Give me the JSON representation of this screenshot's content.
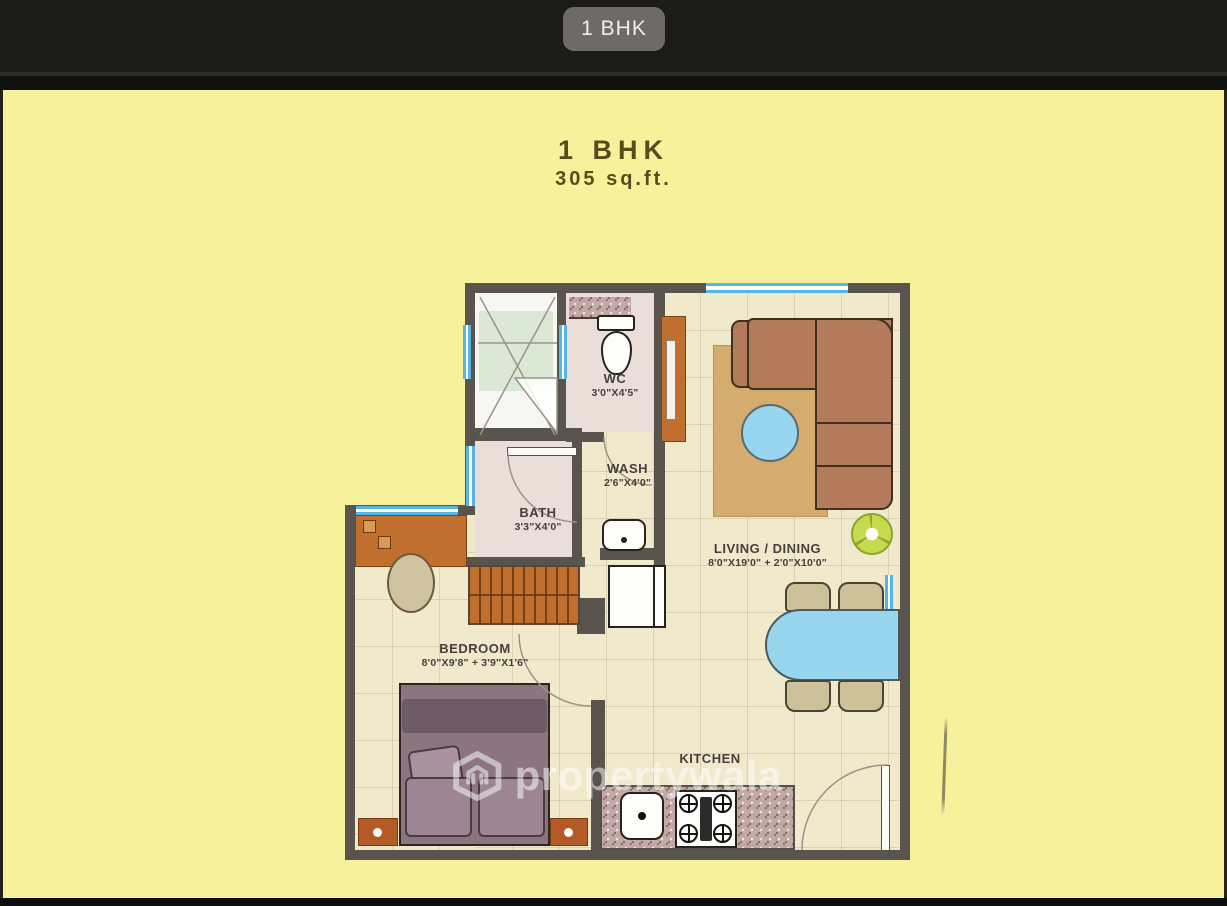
{
  "header": {
    "tab_label": "1 BHK"
  },
  "plan_title": {
    "title": "1 BHK",
    "area": "305 sq.ft."
  },
  "rooms": {
    "wc": {
      "name": "WC",
      "dims": "3'0\"X4'5\""
    },
    "wash": {
      "name": "WASH",
      "dims": "2'6\"X4'0\""
    },
    "bath": {
      "name": "BATH",
      "dims": "3'3\"X4'0\""
    },
    "living_dining": {
      "name": "LIVING / DINING",
      "dims": "8'0\"X19'0\" + 2'0\"X10'0\""
    },
    "bedroom": {
      "name": "BEDROOM",
      "dims": "8'0\"X9'8\" + 3'9\"X1'6\""
    },
    "kitchen": {
      "name": "KITCHEN"
    }
  },
  "watermark": {
    "text": "propertywala"
  },
  "colors": {
    "page_bg": "#f8f19c",
    "topbar_bg": "#1b1b1a",
    "tab_pill_bg": "#6e6a67",
    "title_text": "#5a4a1c",
    "wall": "#59554e",
    "floor": "#f0e9cc",
    "wet_floor": "#e9dfd8",
    "furniture_orange": "#c06f2e",
    "water_blue": "#98d6ef",
    "sofa_brown": "#b37a5b",
    "rug_tan": "#d4ac6e",
    "granite": "#c2a9a5",
    "plant_green": "#c8da4f",
    "label_text": "#45403a"
  }
}
